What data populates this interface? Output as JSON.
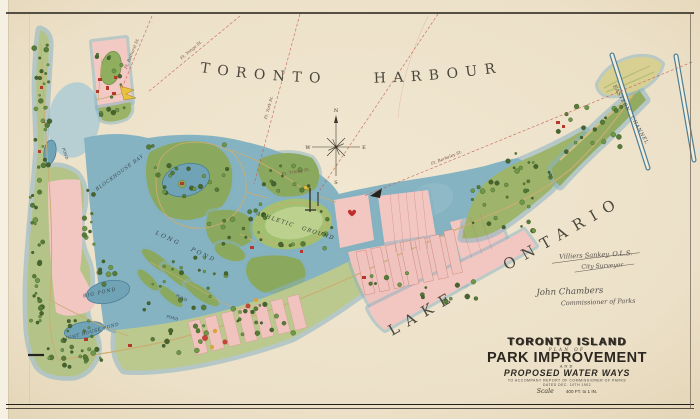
{
  "map": {
    "water_labels": {
      "harbour": "TORONTO HARBOUR",
      "lake": "LAKE ONTARIO",
      "eastern_channel": "EASTERN CHANNEL",
      "blockhouse_bay": "BLOCKHOUSE BAY",
      "long_pond": "LONG POND",
      "big_pond": "BIG POND",
      "lighthouse_pond": "LIGHT HOUSE POND",
      "pond_a": "POND",
      "pond_b": "POND",
      "pond_c": "POND"
    },
    "land_labels": {
      "athletic_grounds": "ATHLETIC GROUNDS"
    },
    "sight_lines": [
      {
        "label": "Ft. Bathurst St."
      },
      {
        "label": "Ft. Yonge St."
      },
      {
        "label": "Ft. York St."
      },
      {
        "label": "Ft. Trinity St."
      },
      {
        "label": "Ft. Berkeley St."
      }
    ],
    "compass": {
      "n": "N",
      "e": "E",
      "s": "S",
      "w": "W"
    },
    "signatures": [
      {
        "name": "Villiers Sankey, O.L.S.",
        "title": "City Surveyor"
      },
      {
        "name": "John Chambers",
        "title": "Commissioner of Parks"
      }
    ],
    "title_block": {
      "line1": "TORONTO ISLAND",
      "line2": "PLAN OF",
      "line3": "PARK IMPROVEMENT",
      "line4": "AND",
      "line5": "PROPOSED WATER WAYS",
      "line6": "TO ACCOMPANY REPORT OF COMMISSIONER OF PARKS",
      "line7": "DATED DEC. 10TH 1902",
      "scale_label": "Scale",
      "scale_value": "400 FT. to 1 IN."
    },
    "colors": {
      "paper": "#ede1c9",
      "water": "#85b3c1",
      "water_deep": "#5d93a8",
      "tree_green": "#5f8a3e",
      "meadow_green": "#a9c077",
      "parcel_pink": "#f2c7c2",
      "sand": "#d9cd8f",
      "building_red": "#b5392b",
      "survey_red": "#c4574c",
      "ink": "#4c473d"
    }
  }
}
